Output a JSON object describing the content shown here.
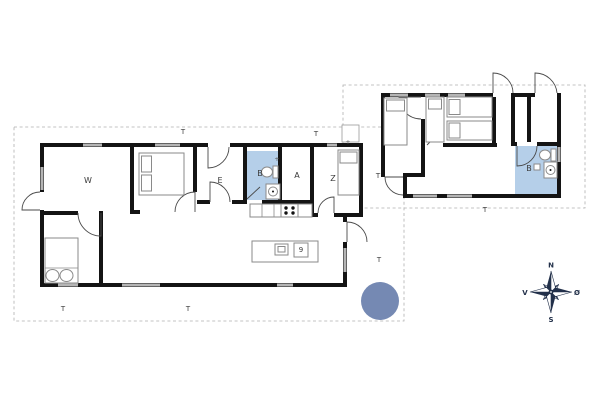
{
  "plan": {
    "main_house": {
      "rooms": {
        "living_w": "W",
        "entrance": "E",
        "bathroom": "B",
        "room_a": "A",
        "room_z": "Z"
      },
      "kitchen": {
        "island_appliance": "9"
      },
      "fixture_marker": "+"
    },
    "annex": {
      "bathroom": "B",
      "fixture_marker": "+"
    },
    "terrace_label": "T",
    "compass": {
      "north": "N",
      "east": "Ø",
      "south": "S",
      "west": "V"
    }
  },
  "colors": {
    "wall": "#141414",
    "window": "#b5b5b5",
    "bathroom": "#b5cfe9",
    "furniture": "#8a8a8a",
    "boundary": "#b0b0b0",
    "hot_tub": "#7589b3",
    "label": "#3a3a3a",
    "compass": "#22304a"
  }
}
